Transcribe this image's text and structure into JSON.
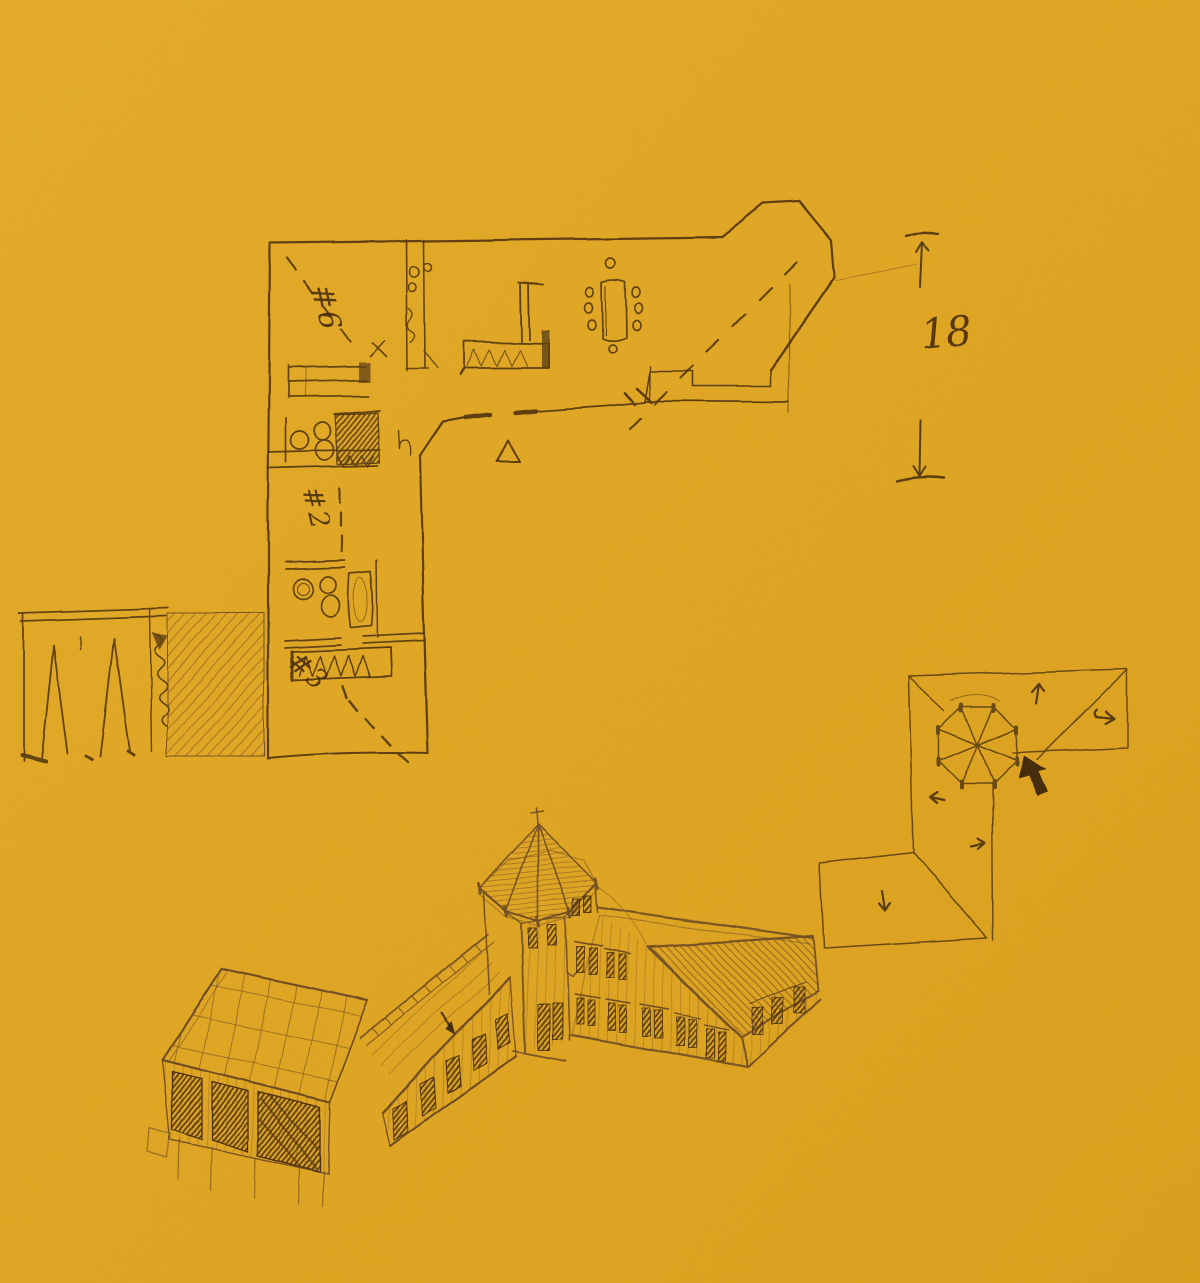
{
  "artwork": {
    "paper_color": "#e3a71f",
    "ink_color": "#4e3312",
    "pencil_color": "#6e4c24"
  },
  "floor_plan": {
    "room_labels": {
      "room6": "#6",
      "room2": "#2",
      "room3": "#3"
    }
  },
  "dimension_note": {
    "value": "18"
  }
}
